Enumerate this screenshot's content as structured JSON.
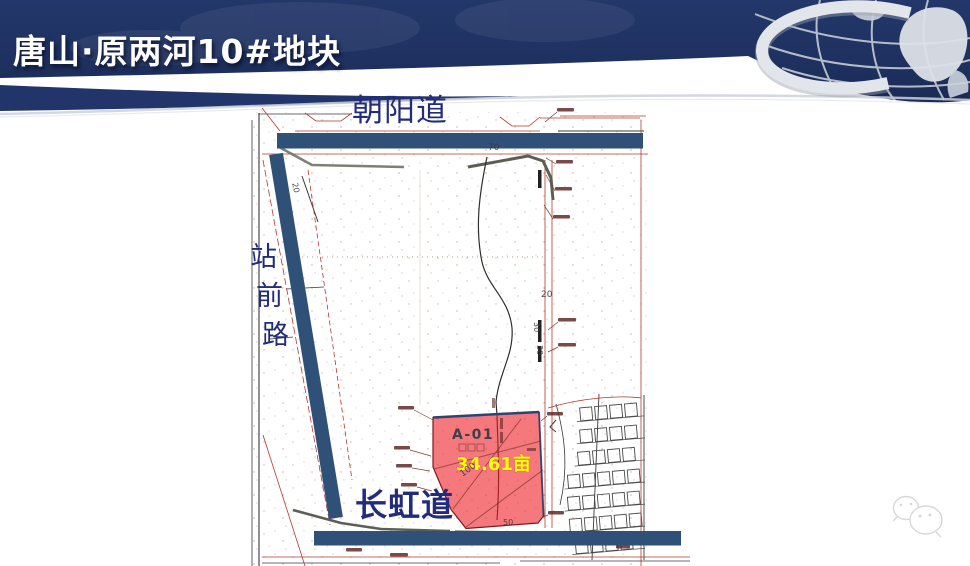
{
  "slide": {
    "title": "唐山·原两河10#地块"
  },
  "header": {
    "navy_color": "#22356B",
    "globe_icon": "silver-globe-with-swoosh"
  },
  "map": {
    "roads": {
      "top": "朝阳道",
      "left": "站前路",
      "left_chars": [
        "站",
        "前",
        "路"
      ],
      "bottom": "长虹道"
    },
    "parcel": {
      "id": "A-01",
      "area": "34.61亩"
    },
    "dims": {
      "top_width": "70",
      "east_20": "20",
      "east_30a": "30",
      "east_30b": "30",
      "inner_100": "100",
      "south_50": "50",
      "west_20": "20"
    },
    "colors": {
      "road_bar_blue": "#2F5077",
      "parcel_red": "#ED1C24",
      "area_text_yellow": "#FFFF00",
      "road_label_blue": "#232C7C",
      "plan_line_red": "#B23A2E"
    }
  },
  "watermark": {
    "icon": "wechat-bubbles"
  }
}
